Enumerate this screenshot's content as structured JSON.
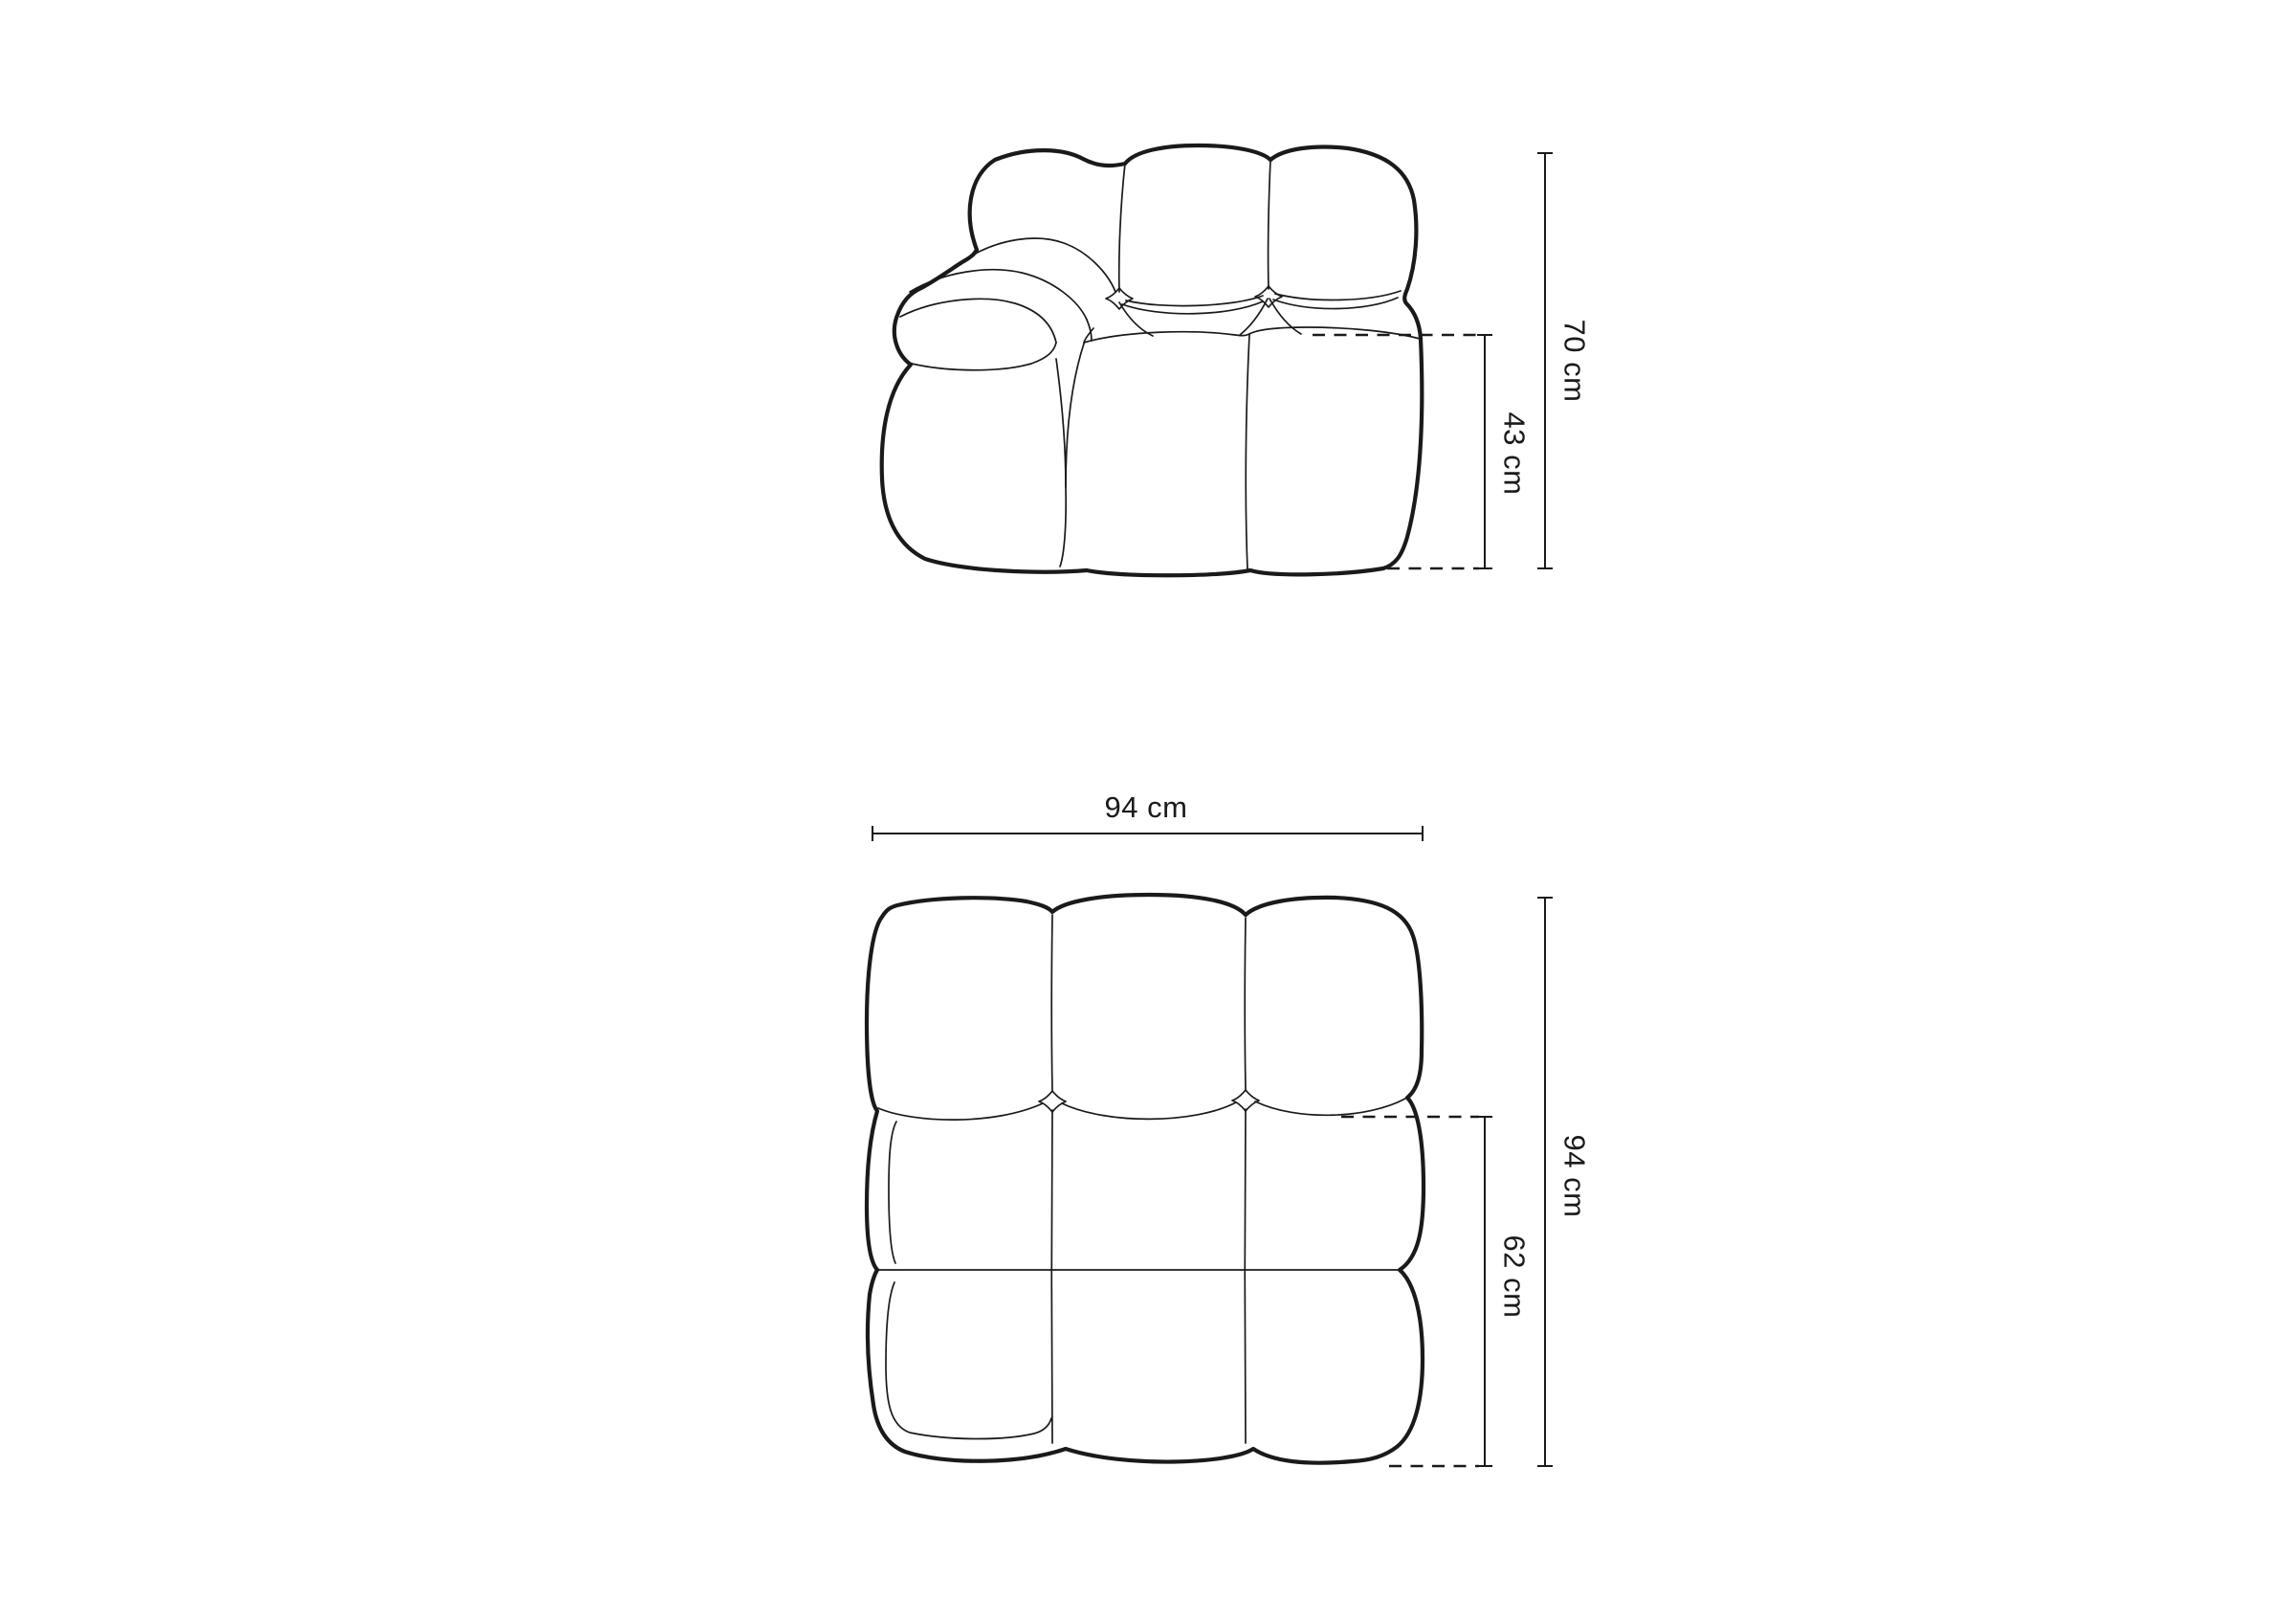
{
  "diagram": {
    "background": "#ffffff",
    "line_color": "#1a1a1a",
    "top_view": {
      "name": "sofa corner module — side view",
      "height_label": "70 cm",
      "seat_height_label": "43 cm"
    },
    "bottom_view": {
      "name": "sofa module — front view",
      "width_label": "94 cm",
      "height_label": "94 cm",
      "seat_height_label": "62 cm"
    }
  }
}
